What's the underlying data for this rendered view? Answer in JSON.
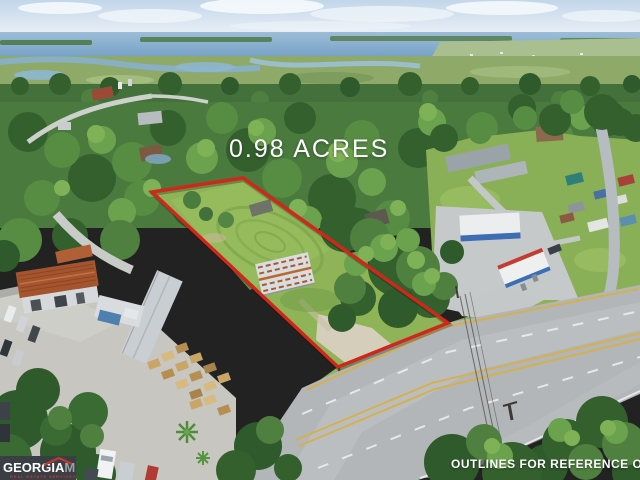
{
  "page": {
    "width": 640,
    "height": 480
  },
  "overlay": {
    "acreage_label": "0.98 ACRES",
    "disclaimer_label": "OUTLINES FOR REFERENCE ONLY",
    "text_color": "#ffffff",
    "property_outline": {
      "points": "152,192 243,178 448,323 338,367",
      "shadow_points": "153,194 244,180 449,325 339,369",
      "color": "#d0271b",
      "stroke_width": "3.5"
    }
  },
  "watermark_logo": {
    "brand_primary": "GEORGIA",
    "brand_secondary": "MLS",
    "tagline": "REAL ESTATE SERVICES",
    "colors": {
      "background": "#3a3f45",
      "primary_text": "#ffffff",
      "secondary_text": "#9aa1a8",
      "accent_red": "#c23a2e"
    }
  },
  "scene": {
    "type": "aerial-drone-photo",
    "description": "Oblique aerial photo of a 0.98-acre roadside parcel outlined in red, between an industrial yard and a gas station with storage sheds, fronting a four-lane highway, with dense tree canopy and a coastal marsh and river on the horizon"
  }
}
